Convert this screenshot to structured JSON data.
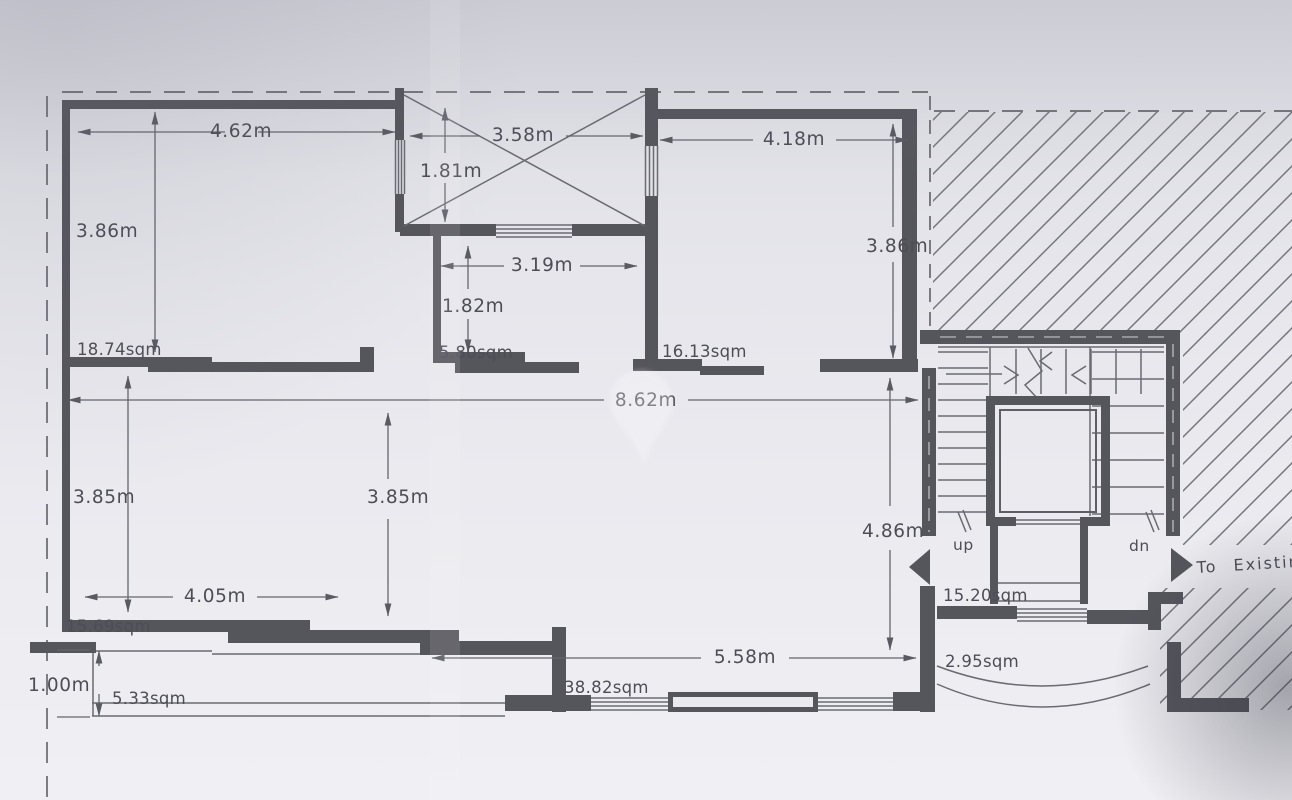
{
  "document_kind": "architectural floor plan (photographed drawing)",
  "colors": {
    "paper": "#e6e6ec",
    "wall_ink": "#55555c",
    "line_ink": "#6a6a72",
    "text_ink": "#4d4d56"
  },
  "plan": {
    "rooms": [
      {
        "id": "top-left-room",
        "area": "18.74sqm",
        "width": "4.62m",
        "height": "3.86m"
      },
      {
        "id": "light-shaft",
        "width": "3.58m",
        "height": "1.81m"
      },
      {
        "id": "small-room",
        "area": "5.80sqm",
        "width": "3.19m",
        "height": "1.82m"
      },
      {
        "id": "top-right-room",
        "area": "16.13sqm",
        "width": "4.18m",
        "height": "3.86m"
      },
      {
        "id": "bottom-left-room",
        "area": "15.69sqm",
        "width": "4.05m",
        "height": "3.85m"
      },
      {
        "id": "living-area",
        "area": "38.82sqm",
        "overall_width": "8.62m",
        "height": "4.86m",
        "partition_height": "3.85m",
        "window_width": "5.58m"
      },
      {
        "id": "front-balcony",
        "area": "5.33sqm",
        "depth": "1.00m"
      },
      {
        "id": "rear-landing",
        "area": "15.20sqm"
      },
      {
        "id": "rear-balcony",
        "area": "2.95sqm"
      }
    ],
    "stairwell": {
      "up_label": "up",
      "down_label": "dn"
    },
    "annotations": {
      "to_existing": "To Existing"
    }
  }
}
